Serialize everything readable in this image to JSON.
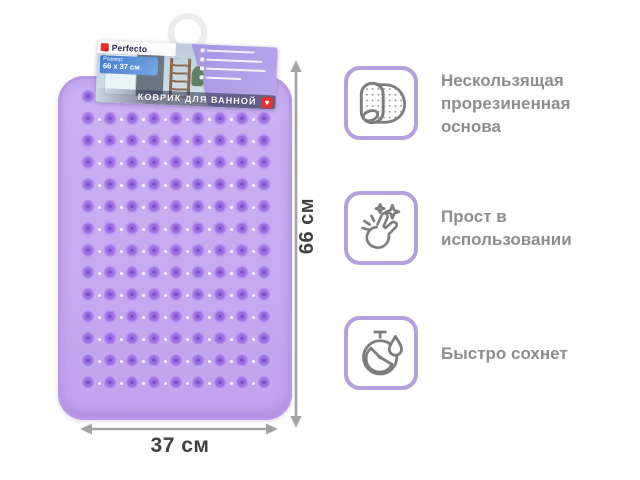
{
  "package": {
    "brand": "Perfecto",
    "size_caption": "Размер:",
    "size_value": "66 x 37 см",
    "title": "КОВРИК ДЛЯ ВАННОЙ",
    "badge_heart": "♥"
  },
  "dimensions": {
    "height": "66 см",
    "width": "37 см"
  },
  "features": [
    {
      "icon": "textured-mat-icon",
      "text": "Нескользящая прорезиненная основа"
    },
    {
      "icon": "snap-fingers-icon",
      "text": "Прост в использовании"
    },
    {
      "icon": "stopwatch-droplet-icon",
      "text": "Быстро сохнет"
    }
  ],
  "mat": {
    "rows": 14,
    "cols": 9
  },
  "colors": {
    "mat_base": "#c6abee",
    "mat_cup": "#9a6fe0",
    "card_border": "#b3a0de",
    "icon_stroke": "#7d7d7d",
    "feature_text": "#8d8d8d",
    "arrow": "#a3a3a3",
    "dimension_text": "#3f3f3f",
    "badge_red": "#e8312a"
  }
}
